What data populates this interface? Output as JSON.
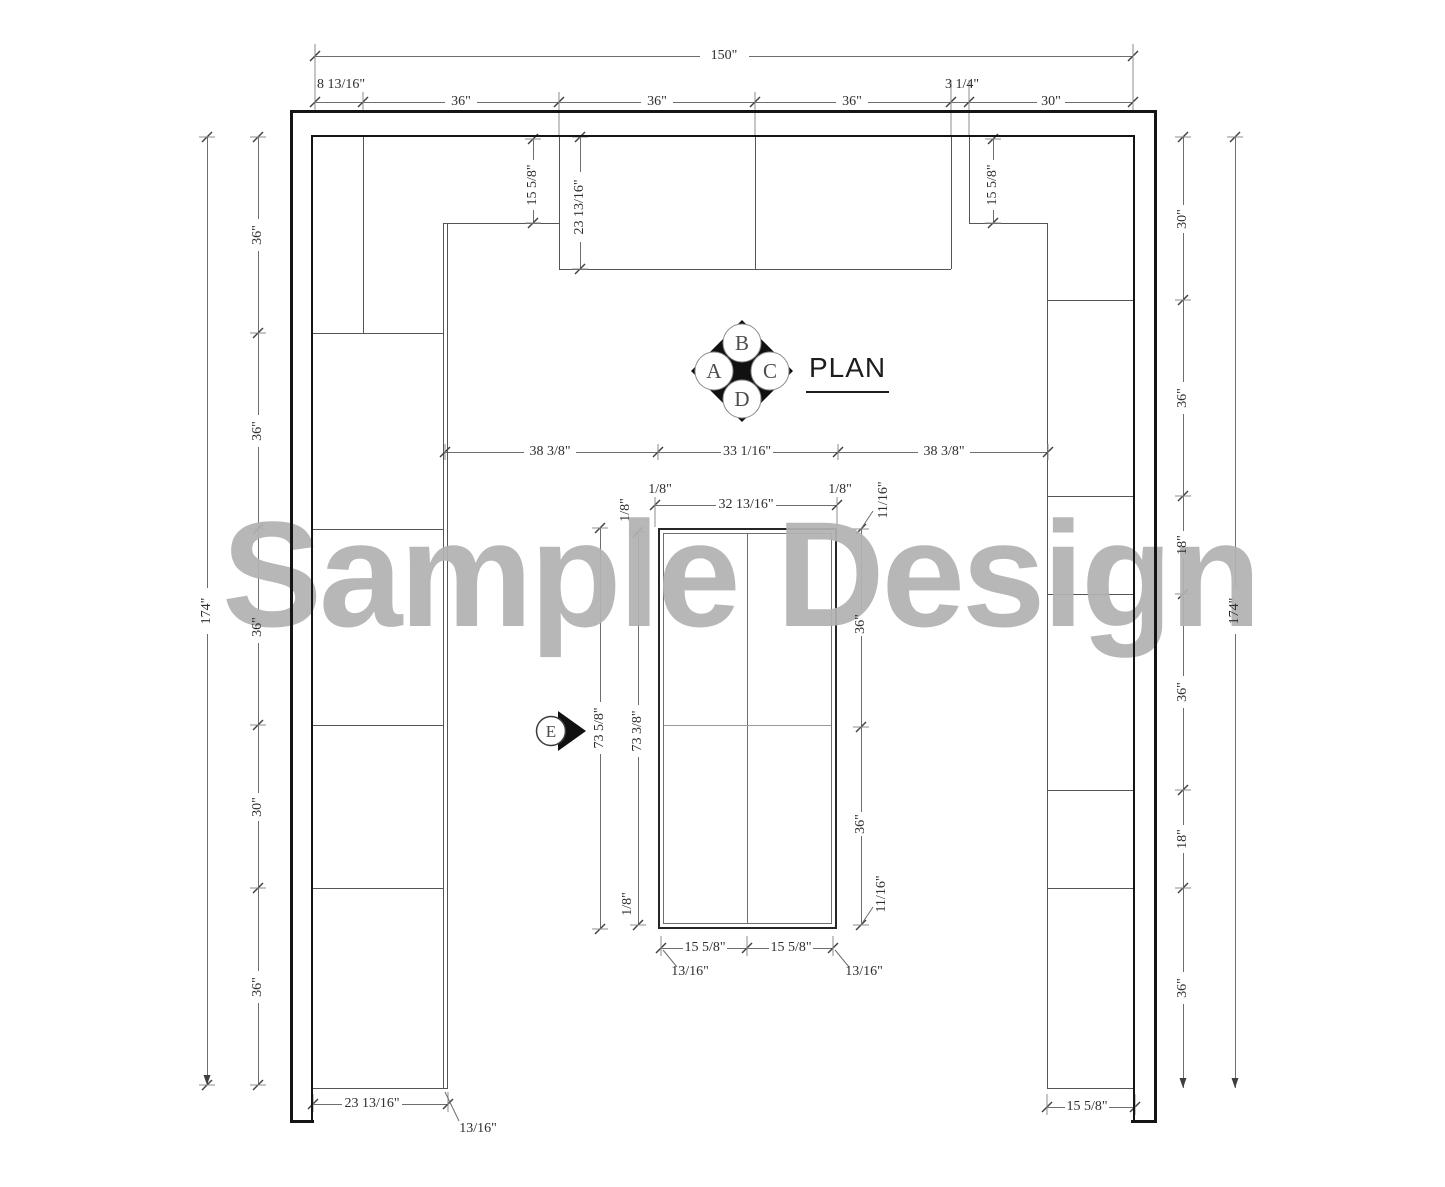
{
  "drawing": {
    "plan_label": "PLAN",
    "watermark": "Sample Design",
    "elevation_marker": "E",
    "compass": {
      "left": "A",
      "top": "B",
      "right": "C",
      "bottom": "D"
    }
  },
  "colors": {
    "wall": "#141414",
    "cabinet_line": "#555555",
    "dimension_line": "#6e6e6e",
    "text": "#2e2e2e",
    "watermark": "#b2b2b2"
  },
  "dimension_labels": [
    {
      "text": "150\"",
      "x": 724,
      "y": 56,
      "rot": 0
    },
    {
      "text": "8 13/16\"",
      "x": 341,
      "y": 85,
      "rot": 0
    },
    {
      "text": "36\"",
      "x": 461,
      "y": 102,
      "rot": 0
    },
    {
      "text": "36\"",
      "x": 657,
      "y": 102,
      "rot": 0
    },
    {
      "text": "36\"",
      "x": 852,
      "y": 102,
      "rot": 0
    },
    {
      "text": "3 1/4\"",
      "x": 962,
      "y": 85,
      "rot": 0
    },
    {
      "text": "30\"",
      "x": 1051,
      "y": 102,
      "rot": 0
    },
    {
      "text": "174\"",
      "x": 207,
      "y": 611,
      "rot": 1
    },
    {
      "text": "36\"",
      "x": 258,
      "y": 235,
      "rot": 1
    },
    {
      "text": "36\"",
      "x": 258,
      "y": 431,
      "rot": 1
    },
    {
      "text": "36\"",
      "x": 258,
      "y": 627,
      "rot": 1
    },
    {
      "text": "30\"",
      "x": 258,
      "y": 807,
      "rot": 1
    },
    {
      "text": "36\"",
      "x": 258,
      "y": 987,
      "rot": 1
    },
    {
      "text": "30\"",
      "x": 1183,
      "y": 219,
      "rot": 1
    },
    {
      "text": "36\"",
      "x": 1183,
      "y": 398,
      "rot": 1
    },
    {
      "text": "18\"",
      "x": 1183,
      "y": 545,
      "rot": 1
    },
    {
      "text": "36\"",
      "x": 1183,
      "y": 692,
      "rot": 1
    },
    {
      "text": "18\"",
      "x": 1183,
      "y": 839,
      "rot": 1
    },
    {
      "text": "36\"",
      "x": 1183,
      "y": 988,
      "rot": 1
    },
    {
      "text": "174\"",
      "x": 1235,
      "y": 611,
      "rot": 1
    },
    {
      "text": "15 5/8\"",
      "x": 533,
      "y": 185,
      "rot": 1
    },
    {
      "text": "23 13/16\"",
      "x": 580,
      "y": 207,
      "rot": 1
    },
    {
      "text": "15 5/8\"",
      "x": 993,
      "y": 185,
      "rot": 1
    },
    {
      "text": "38 3/8\"",
      "x": 550,
      "y": 452,
      "rot": 0
    },
    {
      "text": "33 1/16\"",
      "x": 747,
      "y": 452,
      "rot": 0
    },
    {
      "text": "38 3/8\"",
      "x": 944,
      "y": 452,
      "rot": 0
    },
    {
      "text": "1/8\"",
      "x": 660,
      "y": 490,
      "rot": 0
    },
    {
      "text": "32 13/16\"",
      "x": 746,
      "y": 505,
      "rot": 0
    },
    {
      "text": "1/8\"",
      "x": 840,
      "y": 490,
      "rot": 0
    },
    {
      "text": "1/8\"",
      "x": 626,
      "y": 510,
      "rot": 1
    },
    {
      "text": "11/16\"",
      "x": 884,
      "y": 500,
      "rot": 1
    },
    {
      "text": "73 5/8\"",
      "x": 600,
      "y": 728,
      "rot": 1
    },
    {
      "text": "73 3/8\"",
      "x": 638,
      "y": 731,
      "rot": 1
    },
    {
      "text": "1/8\"",
      "x": 628,
      "y": 904,
      "rot": 1
    },
    {
      "text": "36\"",
      "x": 861,
      "y": 624,
      "rot": 1
    },
    {
      "text": "36\"",
      "x": 861,
      "y": 824,
      "rot": 1
    },
    {
      "text": "11/16\"",
      "x": 882,
      "y": 894,
      "rot": 1
    },
    {
      "text": "15 5/8\"",
      "x": 705,
      "y": 948,
      "rot": 0
    },
    {
      "text": "15 5/8\"",
      "x": 791,
      "y": 948,
      "rot": 0
    },
    {
      "text": "13/16\"",
      "x": 690,
      "y": 972,
      "rot": 0
    },
    {
      "text": "13/16\"",
      "x": 864,
      "y": 972,
      "rot": 0
    },
    {
      "text": "23 13/16\"",
      "x": 372,
      "y": 1104,
      "rot": 0
    },
    {
      "text": "13/16\"",
      "x": 478,
      "y": 1129,
      "rot": 0
    },
    {
      "text": "15 5/8\"",
      "x": 1087,
      "y": 1107,
      "rot": 0
    }
  ]
}
